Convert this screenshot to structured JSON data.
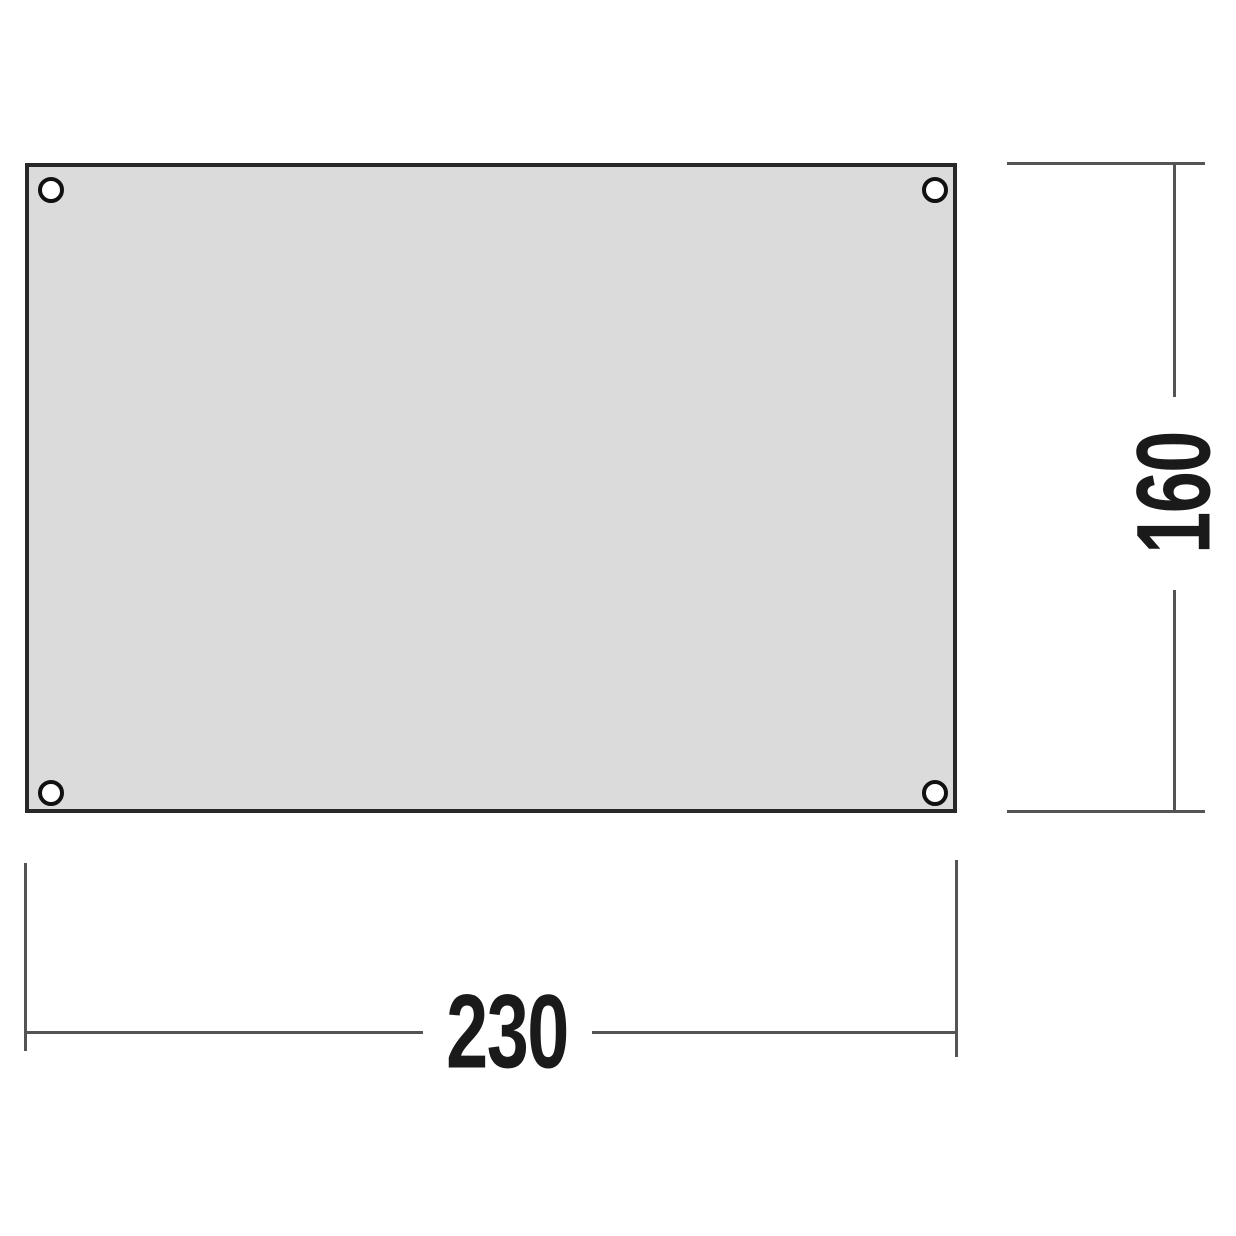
{
  "colors": {
    "background": "#ffffff",
    "panel_fill": "#dbdbdb",
    "panel_border": "#282828",
    "hole_fill": "#ffffff",
    "hole_stroke": "#111111",
    "line": "#545454",
    "text": "#1a1a1a"
  },
  "diagram": {
    "width_dimension": {
      "label": "230"
    },
    "height_dimension": {
      "label": "160"
    }
  }
}
